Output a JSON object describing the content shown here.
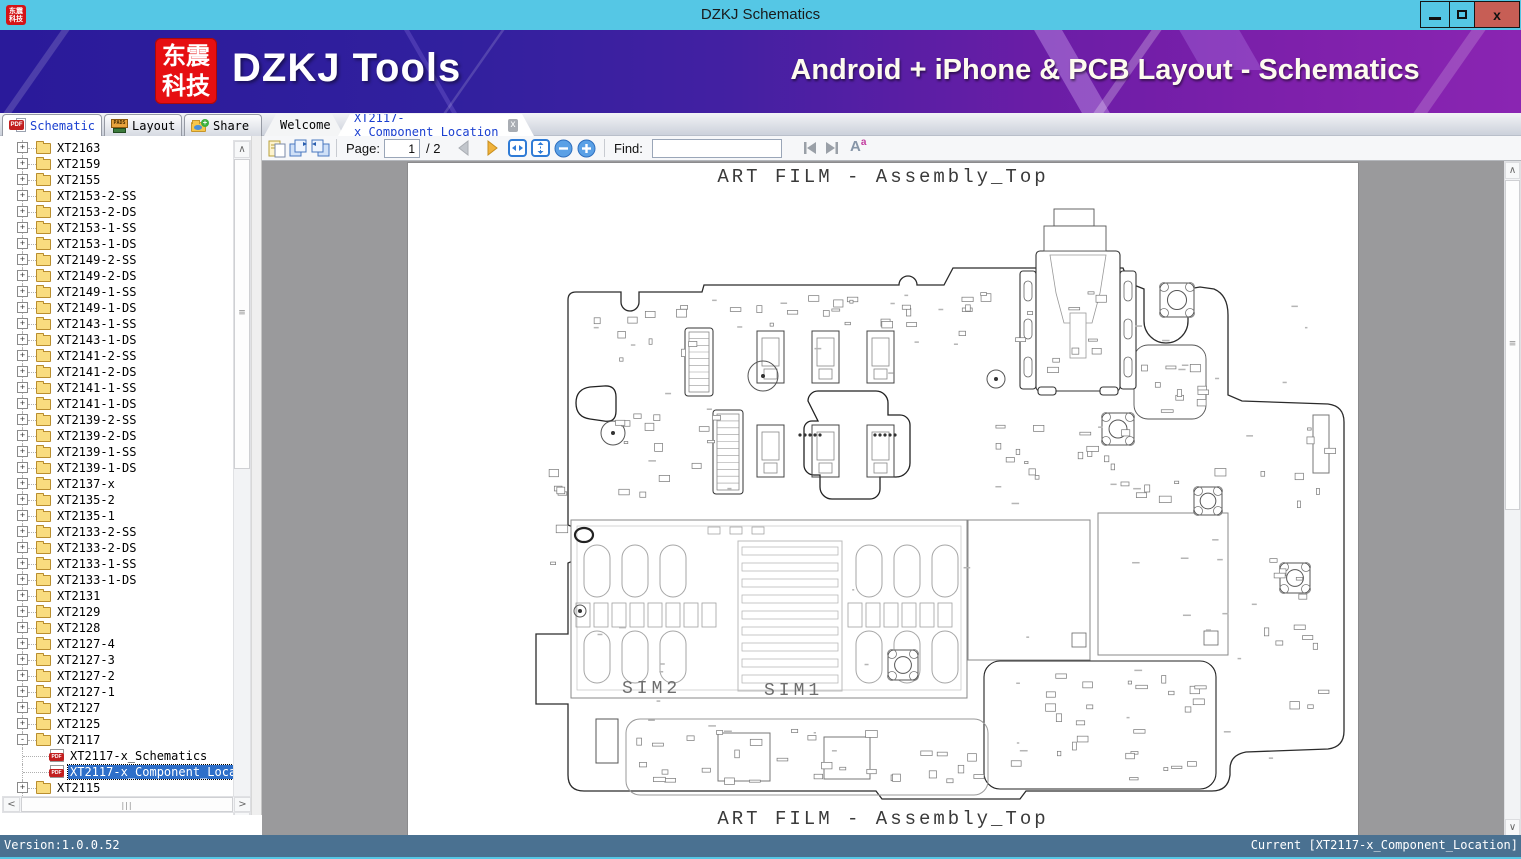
{
  "window": {
    "title": "DZKJ Schematics",
    "logo_line1": "东震",
    "logo_line2": "科技"
  },
  "banner": {
    "brand": "DZKJ Tools",
    "tagline": "Android + iPhone & PCB Layout - Schematics"
  },
  "icons": {
    "pdf_label": "PDF",
    "pads_label": "PADS",
    "close_x": "x",
    "plus": "+",
    "minus": "-",
    "share_plus": "+"
  },
  "tabs": {
    "main": [
      {
        "label": "Schematic",
        "icon": "pdf",
        "active": true
      },
      {
        "label": "Layout",
        "icon": "pads",
        "active": false
      },
      {
        "label": "Share",
        "icon": "share-folder",
        "active": false
      }
    ],
    "docs": [
      {
        "label": "Welcome",
        "active": false
      },
      {
        "label": "XT2117-x_Component_Location",
        "active": true,
        "closable": true
      }
    ]
  },
  "toolbar": {
    "page_label": "Page:",
    "page_value": "1",
    "page_suffix": "/ 2",
    "find_label": "Find:",
    "find_value": ""
  },
  "sidebar": {
    "items": [
      {
        "label": "XT2163",
        "icon": "folder",
        "exp": "plus"
      },
      {
        "label": "XT2159",
        "icon": "folder",
        "exp": "plus"
      },
      {
        "label": "XT2155",
        "icon": "folder",
        "exp": "plus"
      },
      {
        "label": "XT2153-2-SS",
        "icon": "folder",
        "exp": "plus"
      },
      {
        "label": "XT2153-2-DS",
        "icon": "folder",
        "exp": "plus"
      },
      {
        "label": "XT2153-1-SS",
        "icon": "folder",
        "exp": "plus"
      },
      {
        "label": "XT2153-1-DS",
        "icon": "folder",
        "exp": "plus"
      },
      {
        "label": "XT2149-2-SS",
        "icon": "folder",
        "exp": "plus"
      },
      {
        "label": "XT2149-2-DS",
        "icon": "folder",
        "exp": "plus"
      },
      {
        "label": "XT2149-1-SS",
        "icon": "folder",
        "exp": "plus"
      },
      {
        "label": "XT2149-1-DS",
        "icon": "folder",
        "exp": "plus"
      },
      {
        "label": "XT2143-1-SS",
        "icon": "folder",
        "exp": "plus"
      },
      {
        "label": "XT2143-1-DS",
        "icon": "folder",
        "exp": "plus"
      },
      {
        "label": "XT2141-2-SS",
        "icon": "folder",
        "exp": "plus"
      },
      {
        "label": "XT2141-2-DS",
        "icon": "folder",
        "exp": "plus"
      },
      {
        "label": "XT2141-1-SS",
        "icon": "folder",
        "exp": "plus"
      },
      {
        "label": "XT2141-1-DS",
        "icon": "folder",
        "exp": "plus"
      },
      {
        "label": "XT2139-2-SS",
        "icon": "folder",
        "exp": "plus"
      },
      {
        "label": "XT2139-2-DS",
        "icon": "folder",
        "exp": "plus"
      },
      {
        "label": "XT2139-1-SS",
        "icon": "folder",
        "exp": "plus"
      },
      {
        "label": "XT2139-1-DS",
        "icon": "folder",
        "exp": "plus"
      },
      {
        "label": "XT2137-x",
        "icon": "folder",
        "exp": "plus"
      },
      {
        "label": "XT2135-2",
        "icon": "folder",
        "exp": "plus"
      },
      {
        "label": "XT2135-1",
        "icon": "folder",
        "exp": "plus"
      },
      {
        "label": "XT2133-2-SS",
        "icon": "folder",
        "exp": "plus"
      },
      {
        "label": "XT2133-2-DS",
        "icon": "folder",
        "exp": "plus"
      },
      {
        "label": "XT2133-1-SS",
        "icon": "folder",
        "exp": "plus"
      },
      {
        "label": "XT2133-1-DS",
        "icon": "folder",
        "exp": "plus"
      },
      {
        "label": "XT2131",
        "icon": "folder",
        "exp": "plus"
      },
      {
        "label": "XT2129",
        "icon": "folder",
        "exp": "plus"
      },
      {
        "label": "XT2128",
        "icon": "folder",
        "exp": "plus"
      },
      {
        "label": "XT2127-4",
        "icon": "folder",
        "exp": "plus"
      },
      {
        "label": "XT2127-3",
        "icon": "folder",
        "exp": "plus"
      },
      {
        "label": "XT2127-2",
        "icon": "folder",
        "exp": "plus"
      },
      {
        "label": "XT2127-1",
        "icon": "folder",
        "exp": "plus"
      },
      {
        "label": "XT2127",
        "icon": "folder",
        "exp": "plus"
      },
      {
        "label": "XT2125",
        "icon": "folder",
        "exp": "plus"
      },
      {
        "label": "XT2117",
        "icon": "folder",
        "exp": "minus"
      },
      {
        "label": "XT2117-x_Schematics",
        "icon": "pdf",
        "child": true
      },
      {
        "label": "XT2117-x_Component_Location",
        "icon": "pdf",
        "child": true,
        "selected": true
      },
      {
        "label": "XT2115",
        "icon": "folder",
        "exp": "plus"
      },
      {
        "label": "XT2113",
        "icon": "folder",
        "exp": "plus"
      }
    ]
  },
  "viewer": {
    "doc_title_top": "ART FILM - Assembly_Top",
    "doc_title_bottom": "ART FILM - Assembly_Top",
    "sim2": "SIM2",
    "sim1": "SIM1"
  },
  "statusbar": {
    "version": "Version:1.0.0.52",
    "current": "Current [XT2117-x_Component_Location]"
  },
  "colors": {
    "titlebar": "#55c7e5",
    "close_button": "#c75e55",
    "banner_left": "#2a1a9a",
    "banner_right": "#8a25b2",
    "logo_red": "#e60f12",
    "tab_active_text": "#1a3fd0",
    "tree_selection": "#2e6fc9",
    "viewer_bg": "#9a9a9c",
    "statusbar_bg": "#4a7191"
  }
}
